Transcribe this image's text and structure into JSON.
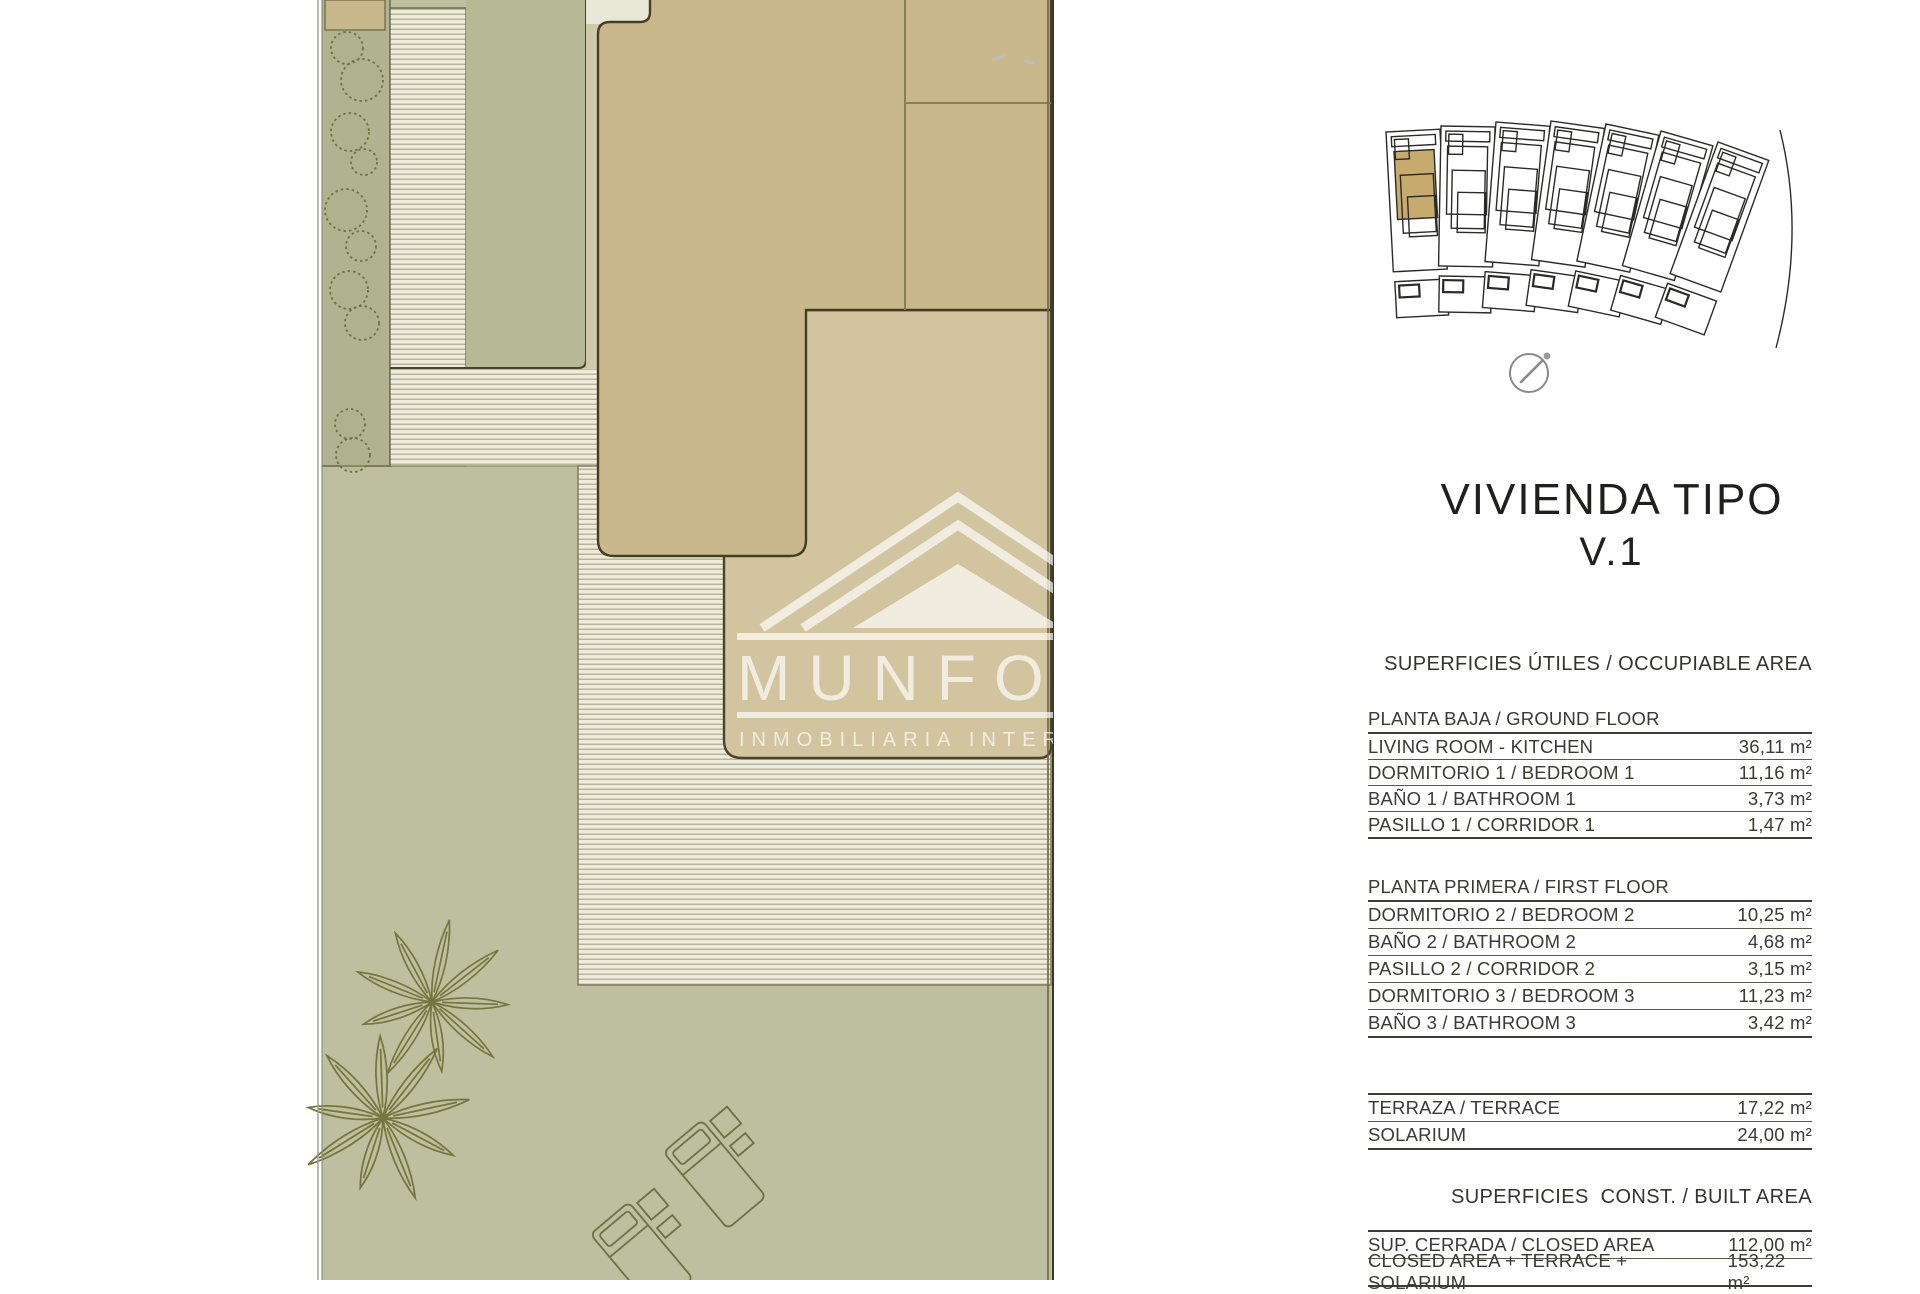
{
  "plan": {
    "watermark": {
      "brand": "MUNFO",
      "subtitle": "INMOBILIARIA INTERNA"
    }
  },
  "panel": {
    "title": "VIVIENDA TIPO",
    "subtitle": "V.1",
    "heading_occupiable": "SUPERFICIES ÚTILES / OCCUPIABLE AREA",
    "heading_built": "SUPERFICIES  CONST. / BUILT AREA",
    "tables": {
      "ground_floor": {
        "title": "PLANTA BAJA / GROUND FLOOR",
        "rows": [
          [
            "LIVING ROOM - KITCHEN",
            "36,11 m²"
          ],
          [
            "DORMITORIO 1 /  BEDROOM 1",
            "11,16 m²"
          ],
          [
            "BAÑO 1 / BATHROOM 1",
            "3,73 m²"
          ],
          [
            "PASILLO 1 / CORRIDOR 1",
            "1,47 m²"
          ]
        ]
      },
      "first_floor": {
        "title": "PLANTA PRIMERA / FIRST FLOOR",
        "rows": [
          [
            "DORMITORIO 2 / BEDROOM 2",
            "10,25 m²"
          ],
          [
            "BAÑO 2 / BATHROOM 2",
            "4,68 m²"
          ],
          [
            "PASILLO 2 / CORRIDOR 2",
            "3,15 m²"
          ],
          [
            "DORMITORIO 3 / BEDROOM 3",
            "11,23 m²"
          ],
          [
            "BAÑO 3 / BATHROOM 3",
            "3,42 m²"
          ]
        ]
      },
      "outdoor": {
        "rows": [
          [
            "TERRAZA / TERRACE",
            "17,22 m²"
          ],
          [
            "SOLARIUM",
            "24,00 m²"
          ]
        ]
      },
      "built": {
        "rows": [
          [
            "SUP. CERRADA / CLOSED AREA",
            "112,00 m²"
          ],
          [
            "CLOSED AREA + TERRACE + SOLARIUM",
            "153,22 m²"
          ]
        ]
      }
    }
  },
  "colors": {
    "building": "#c9b88c",
    "terrace": "#d2c49e",
    "lawn": "#bdbf9e",
    "deck": "#edebd9",
    "deck_line": "#b9b59d",
    "outline": "#453e24",
    "highlight_unit": "#c7ab6e"
  }
}
